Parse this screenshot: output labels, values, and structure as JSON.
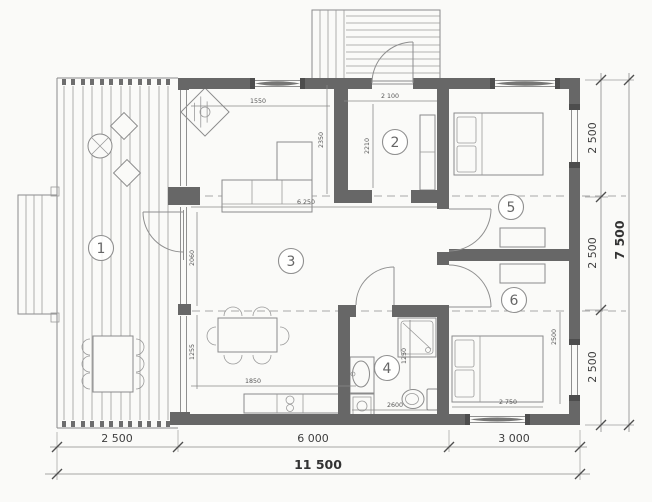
{
  "plan": {
    "rooms": [
      {
        "number": "1"
      },
      {
        "number": "2"
      },
      {
        "number": "3"
      },
      {
        "number": "4"
      },
      {
        "number": "5"
      },
      {
        "number": "6"
      }
    ],
    "dims": {
      "bottom": {
        "seg1": "2 500",
        "seg2": "6 000",
        "seg3": "3 000",
        "total": "11 500"
      },
      "right": {
        "seg1": "2 500",
        "seg2": "2 500",
        "seg3": "2 500",
        "total": "7 500"
      },
      "interior": {
        "entry_width": "2 100",
        "entry_depth": "2210",
        "living_top": "1550",
        "living_east": "2350",
        "living_width": "6 250",
        "west_upper": "2060",
        "west_lower": "1255",
        "kitchen": "1850",
        "bath_width": "2600",
        "shower_height": "1250",
        "bed_width": "2 750",
        "room6_depth": "2500"
      }
    },
    "colors": {
      "wall": "#676767",
      "furniture_line": "#8b8b8b",
      "dim_text": "#4e4e4e",
      "background": "#fafaf8"
    }
  }
}
